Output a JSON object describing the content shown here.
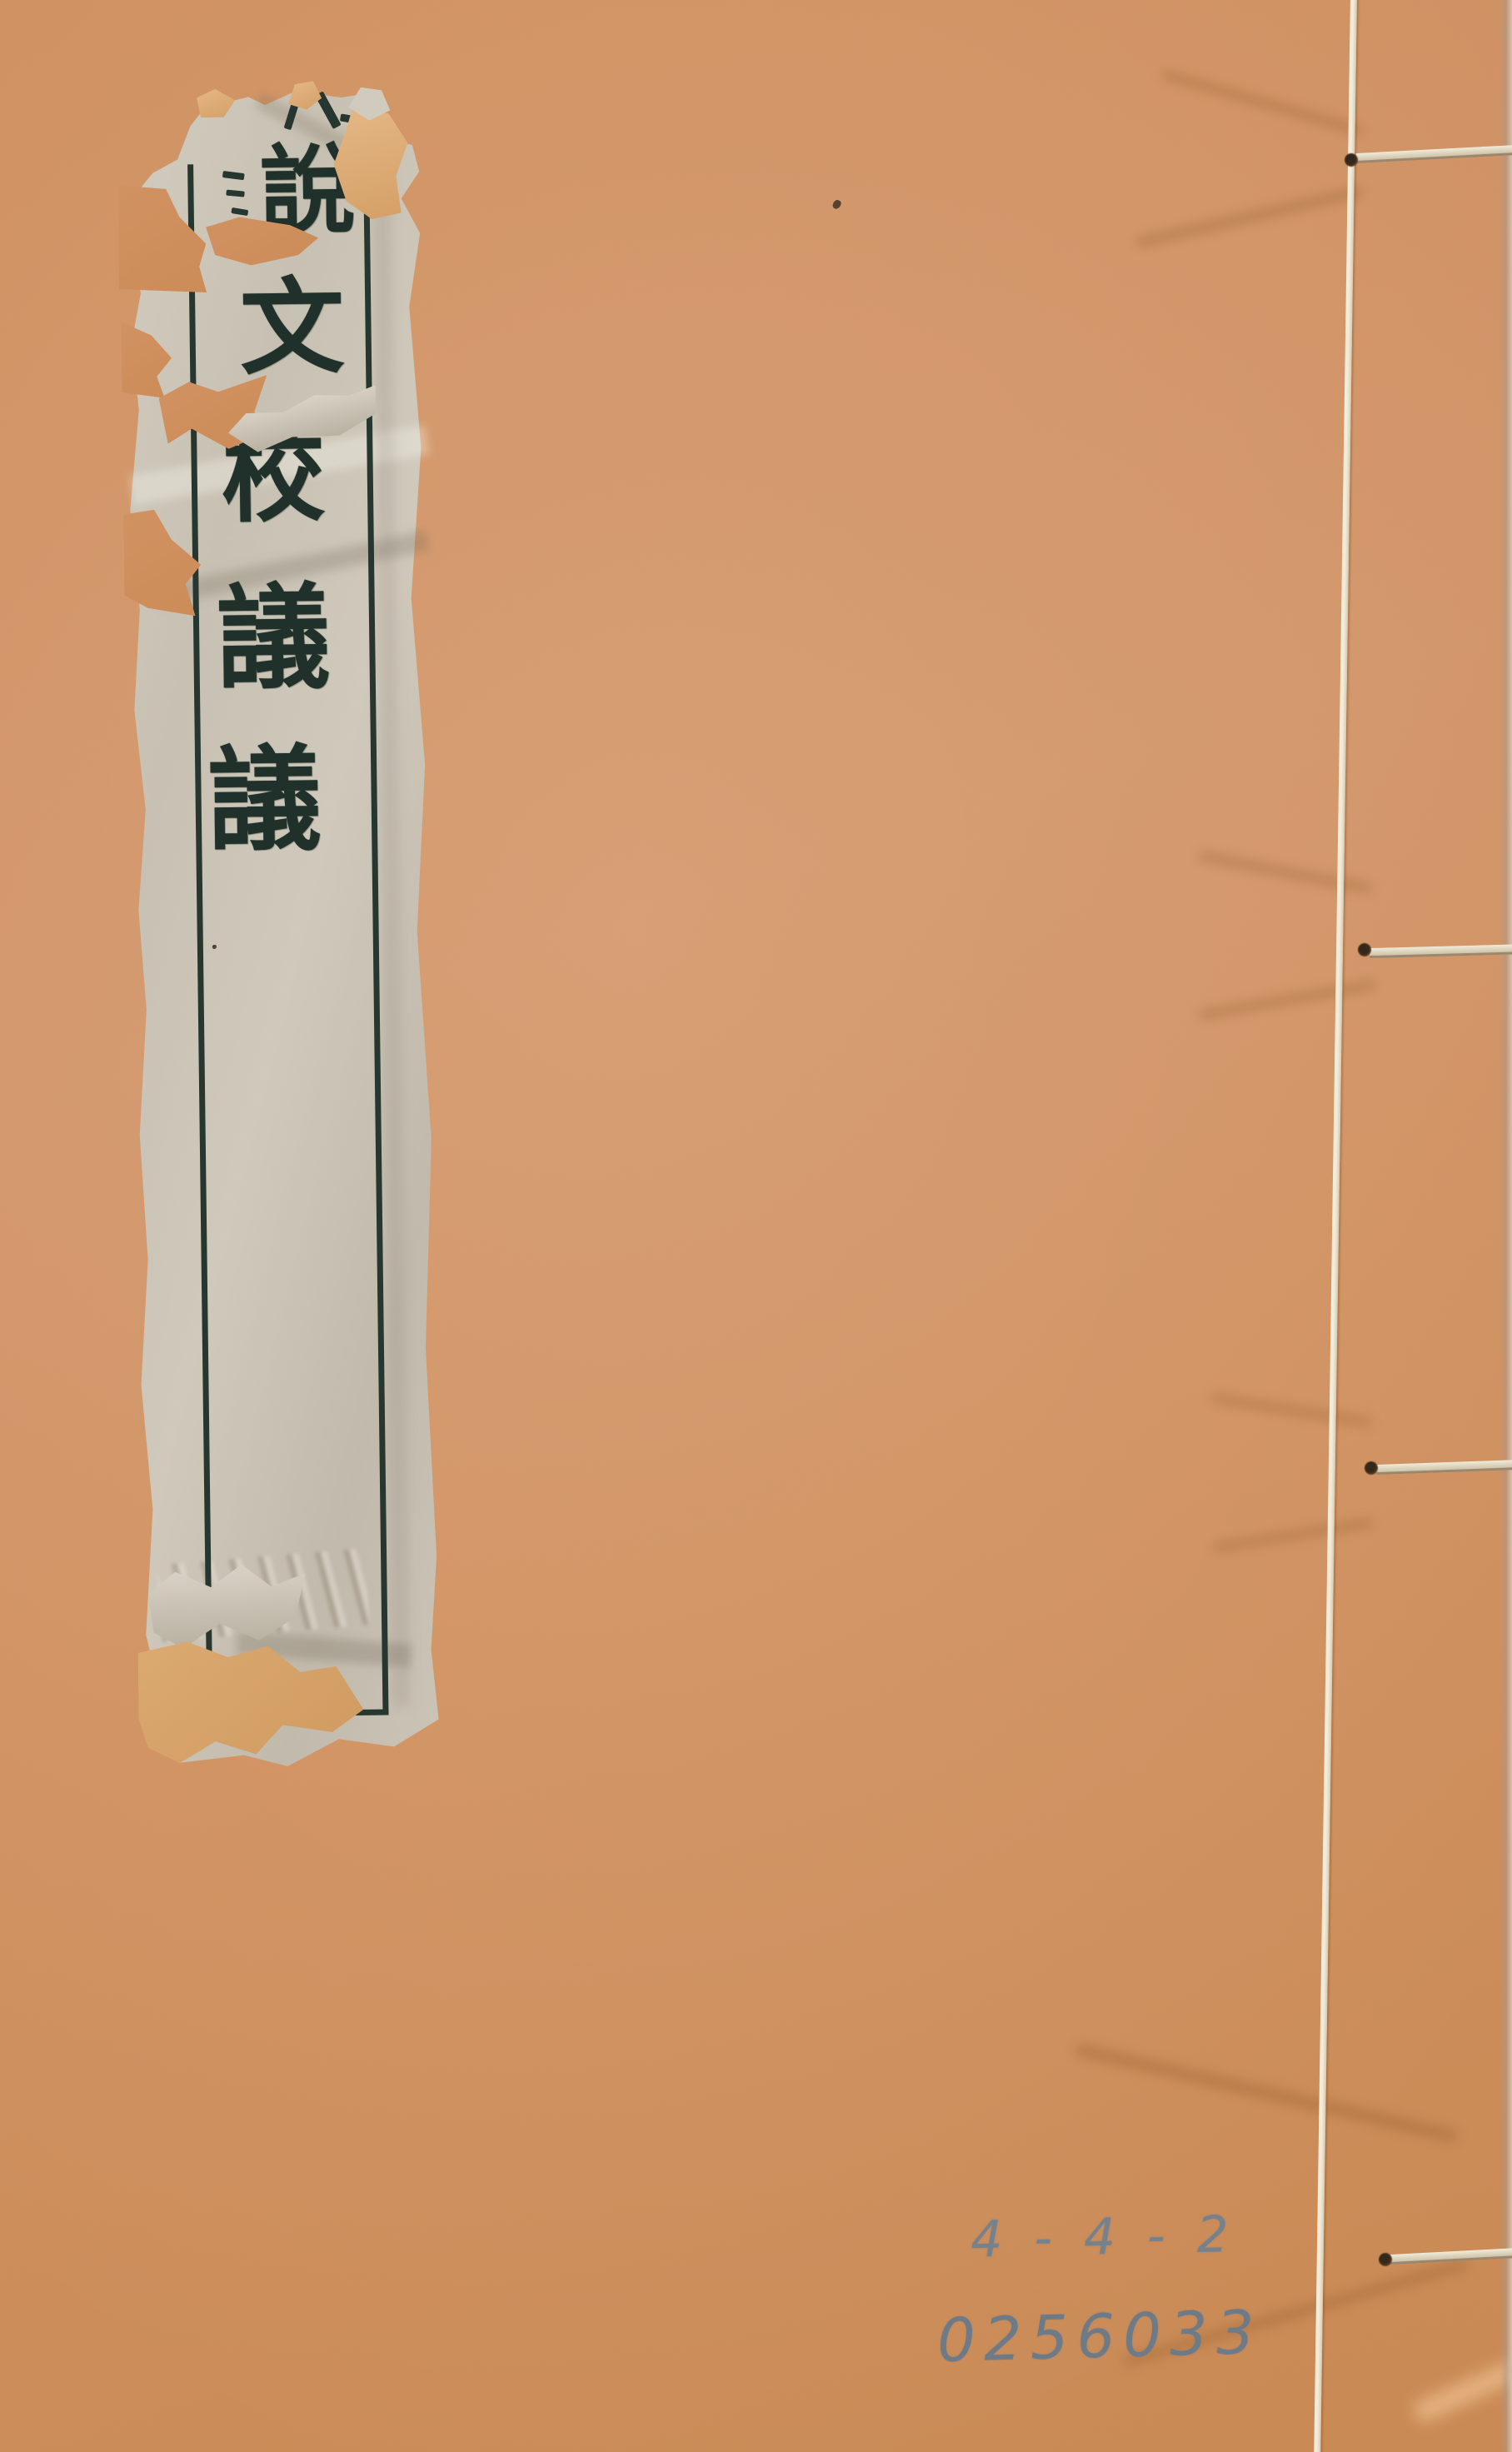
{
  "artifact": {
    "kind": "thread-bound book front cover",
    "cover_color": "#d09264",
    "label": {
      "title": "說文校議議",
      "characters": [
        "說",
        "文",
        "校",
        "議",
        "議"
      ],
      "paper_color": "#ccc6b9",
      "ink_color": "#20312b",
      "patch_color": "#dcab74"
    },
    "binding": {
      "thread_color": "#ece5d3",
      "stitch_count": "4"
    },
    "pencil": {
      "line1": "4-4-2",
      "line2": "0256033",
      "color": "#75818c"
    }
  }
}
